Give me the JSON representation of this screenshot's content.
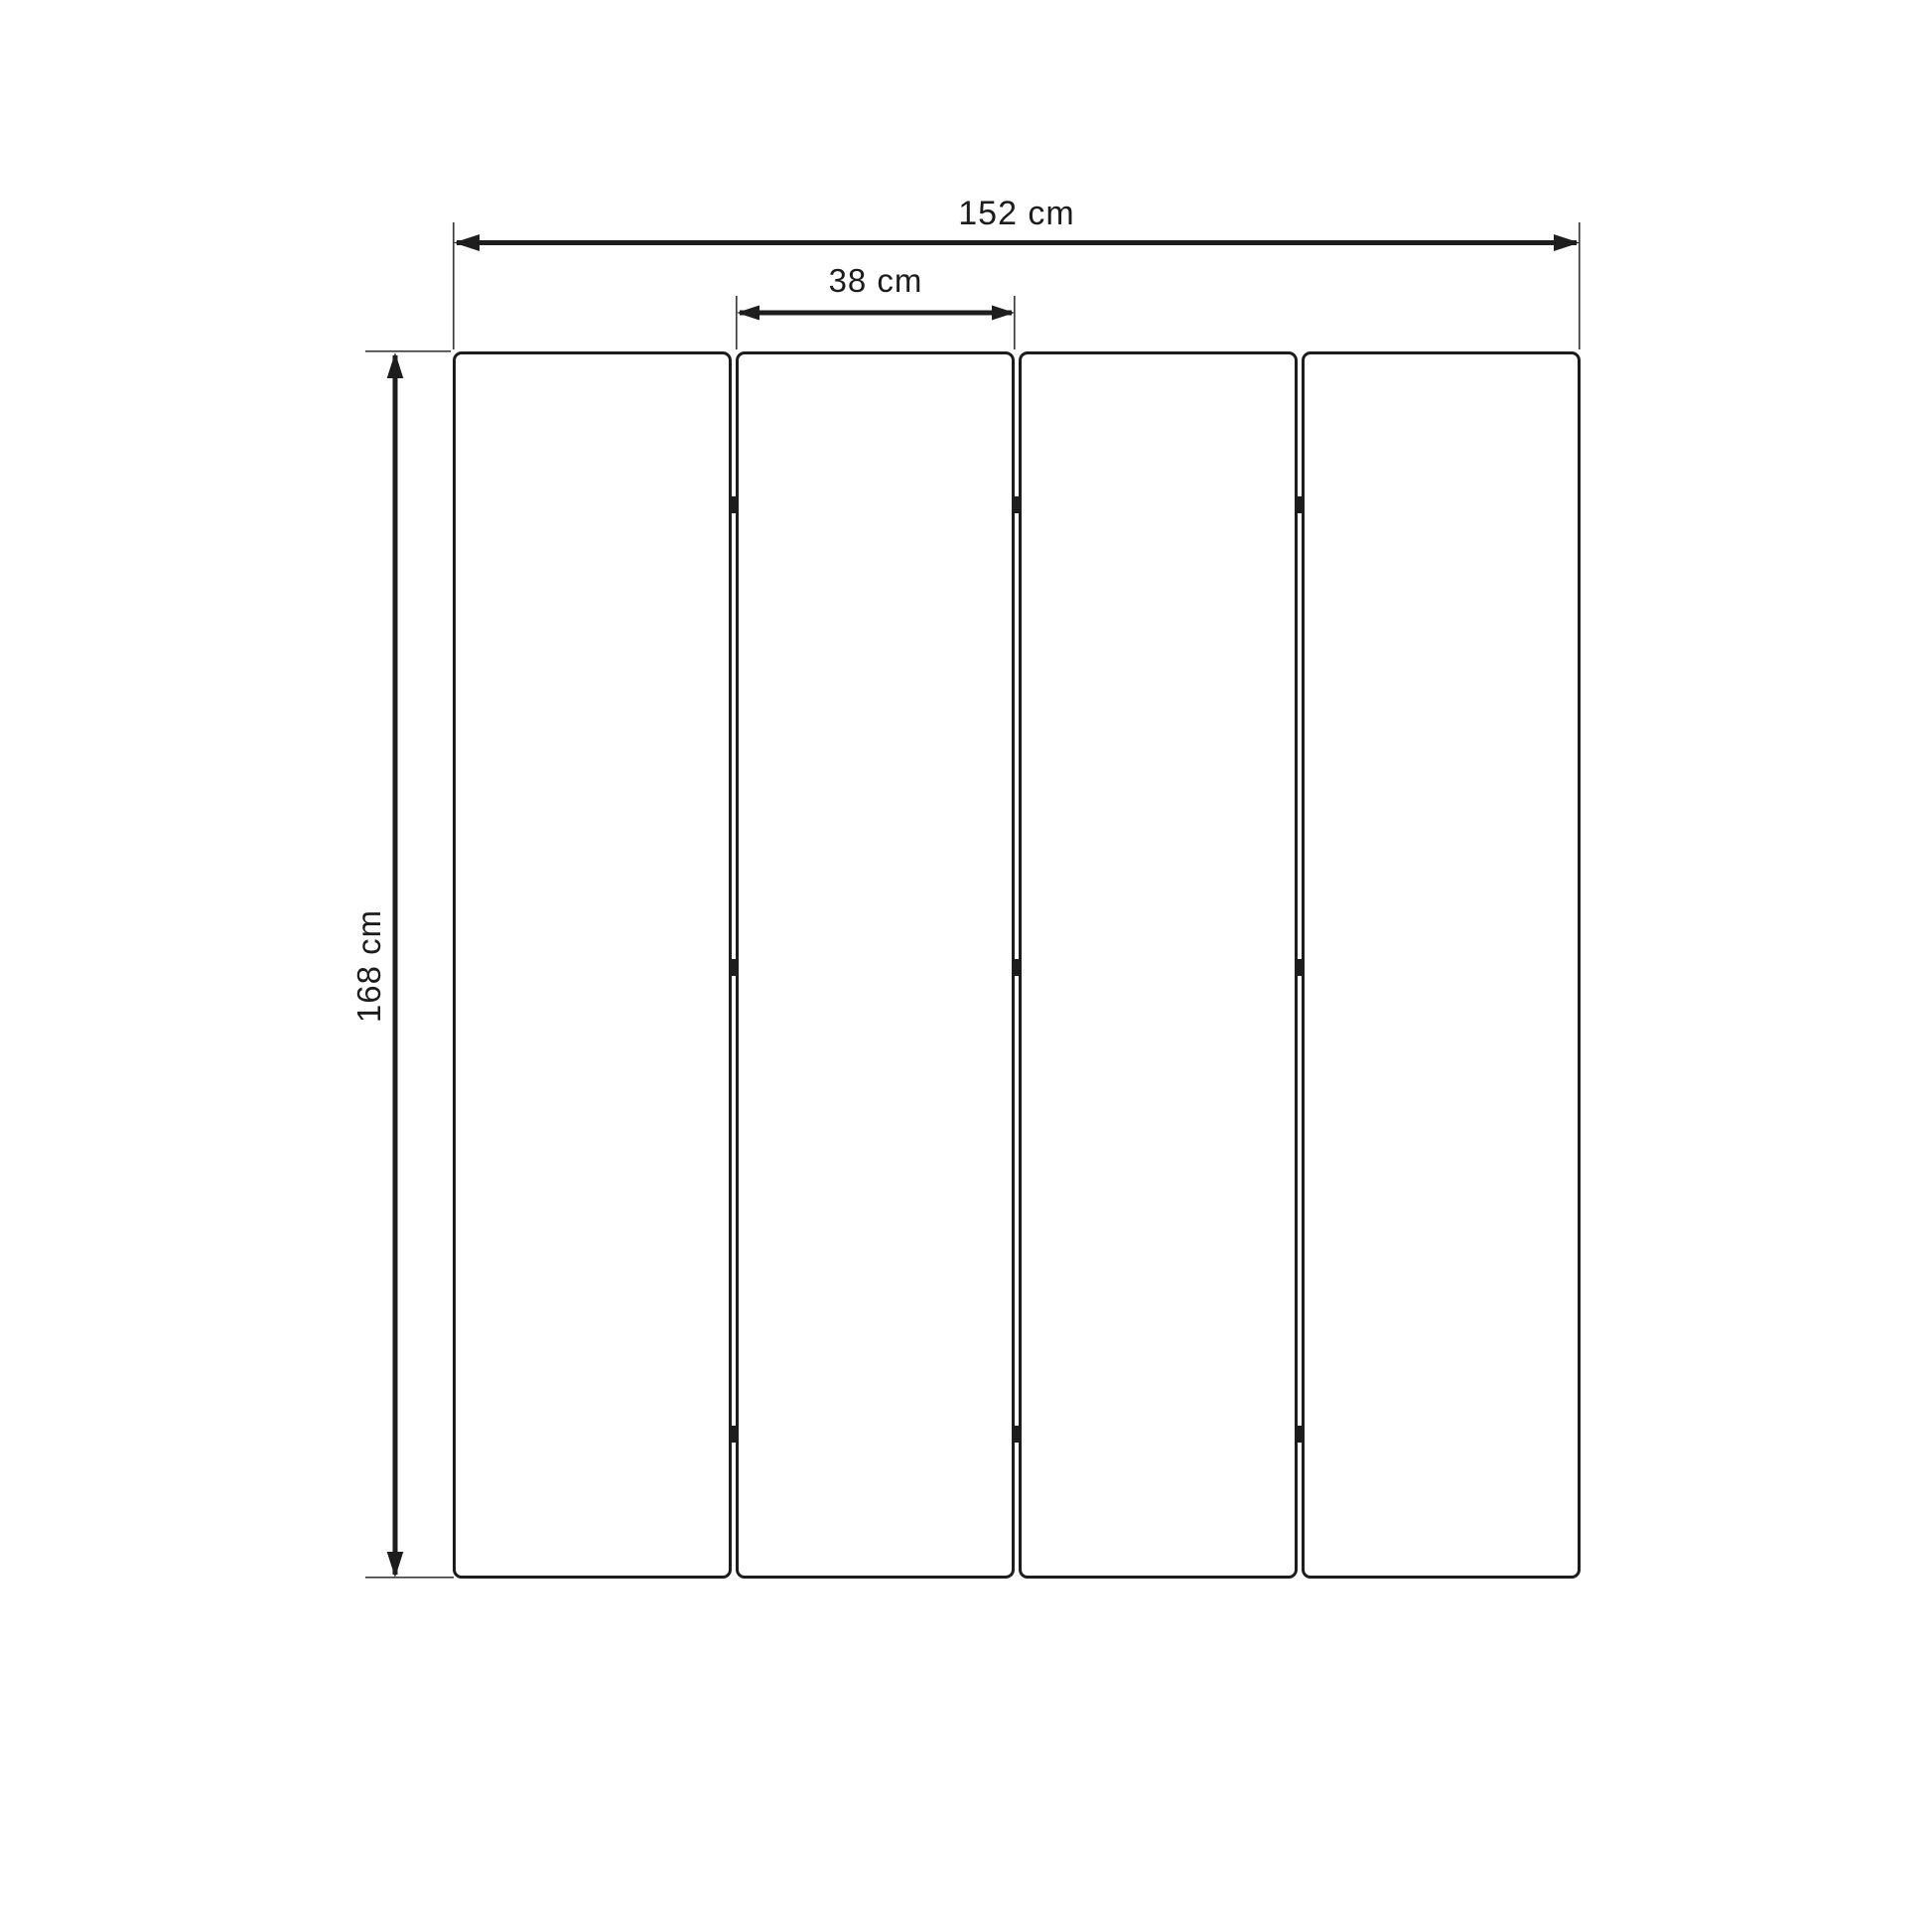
{
  "page": {
    "background_color": "#ffffff",
    "ink_color": "#1d1d1d",
    "extension_line_color": "#3c3c3c"
  },
  "diagram": {
    "panel_count": 4,
    "hinge_rows_per_gap": 3,
    "dimensions": {
      "total_width": {
        "label": "152 cm"
      },
      "panel_width": {
        "label": "38 cm"
      },
      "height": {
        "label": "168 cm"
      }
    }
  }
}
